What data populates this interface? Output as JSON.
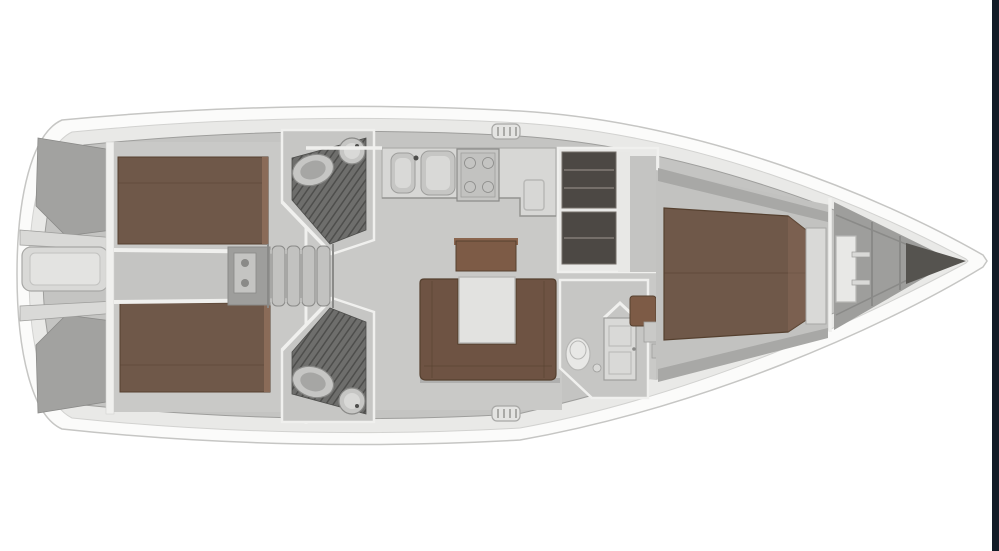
{
  "meta": {
    "description": "Top-down interior floor plan of a cruising sailing yacht, bow pointing right, no text labels rendered",
    "canvas": {
      "width": 999,
      "height": 551
    }
  },
  "colors": {
    "background": "#ffffff",
    "window_edge_bar": "#131b26",
    "hull_white": "#fbfbfa",
    "hull_outline": "#c6c6c4",
    "deck_ring": "#e9e9e7",
    "deck_ring_edge": "#d2d2d0",
    "side_deck": "#c4c4c2",
    "floor": "#c9c9c7",
    "floor_shadow": "#9e9e9c",
    "counter": "#d7d7d5",
    "counter_edge": "#aeaeac",
    "wall_white": "#f0f0ee",
    "wall_shadow": "#8a8a88",
    "bed_brown": "#6f5849",
    "bed_brown_dark": "#55402f",
    "bed_brown_light": "#8a6b58",
    "settee_brown": "#6e5343",
    "sideboard_brown": "#7d5b46",
    "sideboard_brown_light": "#8a654e",
    "table_top": "#e2e2e0",
    "table_edge": "#b7b7b5",
    "wet_floor": "#6e6e6c",
    "wet_floor_stripe": "#4e4e4c",
    "fixture_light": "#e8e8e6",
    "fixture_mid": "#c6c6c4",
    "fixture_edge": "#9e9e9c",
    "locker_dark": "#4c4844",
    "locker_shelf": "#756f6a",
    "bow_floor": "#9e9e9c",
    "bow_dark": "#55534f",
    "transom_gray": "#a2a2a0",
    "platform_light": "#d9d9d7",
    "platform_inner": "#e3e3e1",
    "step_gray": "#c2c2c0",
    "engine_gray": "#9e9e9c",
    "hatch_fill": "#e4e4e2",
    "hatch_edge": "#a8a8a6"
  },
  "vessel": {
    "orientation": "bow-right",
    "areas": [
      {
        "id": "transom-swim-platform",
        "label": "Stern transom with swim platform and lazarette lockers"
      },
      {
        "id": "aft-cabin-port",
        "label": "Aft cabin (top) with brown double berth"
      },
      {
        "id": "aft-cabin-starboard",
        "label": "Aft cabin (bottom) with brown double berth"
      },
      {
        "id": "aft-head-port",
        "label": "Aft head (top) with toilet, basin and shower grate floor"
      },
      {
        "id": "aft-head-starboard",
        "label": "Aft head (bottom) with toilet, basin and shower grate floor"
      },
      {
        "id": "companionway",
        "label": "Companionway steps over engine compartment"
      },
      {
        "id": "galley",
        "label": "L-shaped galley with double sink, stove and fridge lid"
      },
      {
        "id": "salon",
        "label": "Salon with U-shaped settee, white table and sideboard"
      },
      {
        "id": "wardrobe",
        "label": "Shelved wardrobe lockers"
      },
      {
        "id": "forward-head",
        "label": "Forward head with toilet and door"
      },
      {
        "id": "forward-cabin",
        "label": "Forward cabin with island double berth"
      },
      {
        "id": "bow-locker",
        "label": "Bow compartment / anchor locker with hinged access panel"
      }
    ],
    "fixtures": {
      "berth_count": 3,
      "head_count": 3,
      "toilets": 3,
      "basins": 2,
      "shower_grates": 2,
      "salon_table": 1,
      "deck_hatches": 2,
      "galley_sinks": 2,
      "stove_burners": 4
    }
  }
}
